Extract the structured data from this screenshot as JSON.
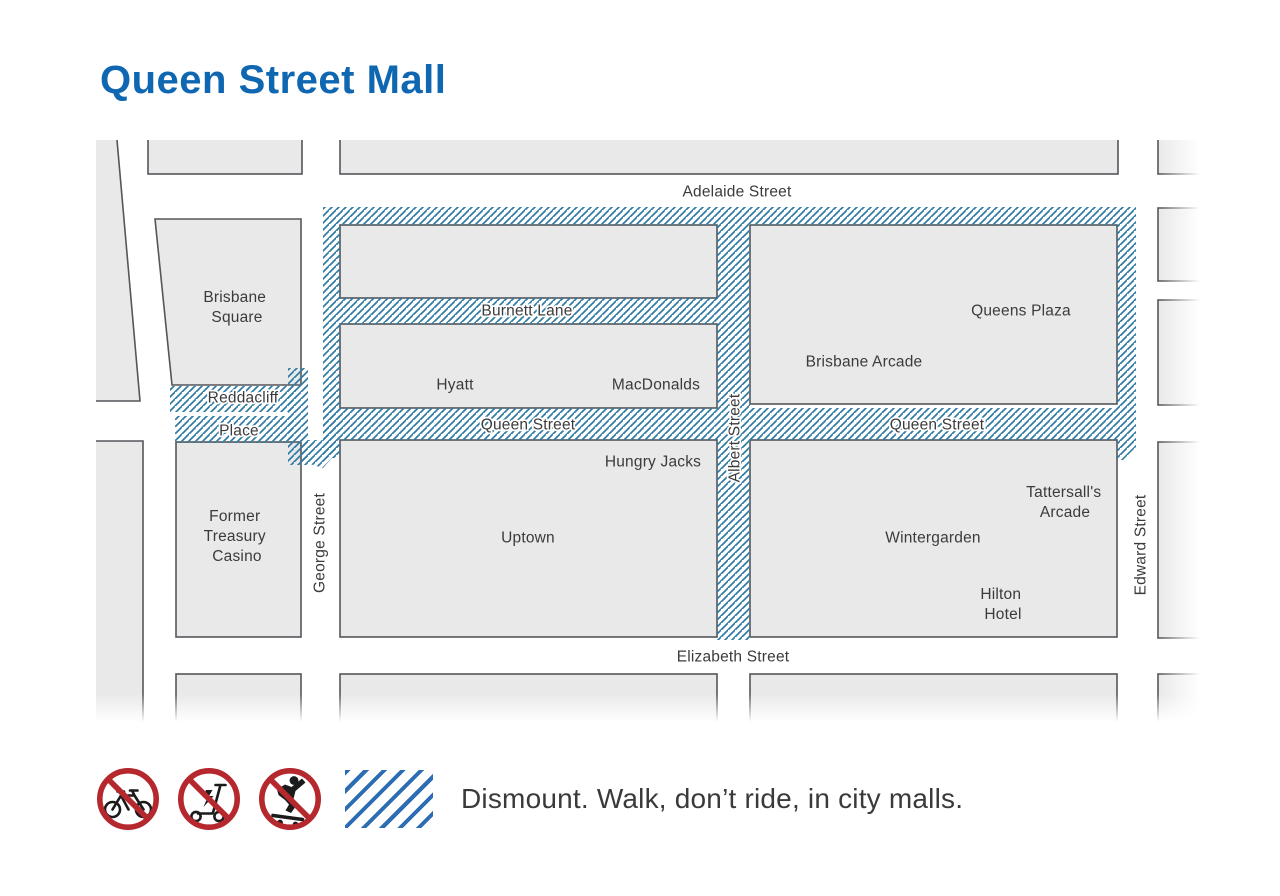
{
  "title": "Queen Street Mall",
  "map": {
    "streets": {
      "adelaide": "Adelaide Street",
      "burnett": "Burnett Lane",
      "queen_west": "Queen Street",
      "queen_east": "Queen Street",
      "elizabeth": "Elizabeth Street",
      "george": "George Street",
      "albert": "Albert Street",
      "edward": "Edward Street",
      "reddacliff": [
        "Reddacliff",
        "Place"
      ]
    },
    "places": {
      "brisbane_square": [
        "Brisbane",
        "Square"
      ],
      "former_treasury": [
        "Former",
        "Treasury",
        "Casino"
      ],
      "hyatt": "Hyatt",
      "macdonalds": "MacDonalds",
      "hungry_jacks": "Hungry Jacks",
      "uptown": "Uptown",
      "queens_plaza": "Queens Plaza",
      "brisbane_arcade": "Brisbane Arcade",
      "tattersalls": [
        "Tattersall's",
        "Arcade"
      ],
      "wintergarden": "Wintergarden",
      "hilton": [
        "Hilton",
        "Hotel"
      ]
    }
  },
  "legend": {
    "icons": [
      "no-bicycle",
      "no-e-scooter",
      "no-skateboard",
      "dismount-zone-hatch"
    ],
    "text": "Dismount. Walk, don’t ride, in city malls."
  },
  "colors": {
    "accent": "#0f67b1",
    "hatch": "#2f7ba3",
    "legend_hatch": "#2d6db3",
    "prohibition_red": "#b4282e",
    "building_fill": "#e9e9ea",
    "building_stroke": "#55565a",
    "label_text": "#3b3b3d"
  }
}
